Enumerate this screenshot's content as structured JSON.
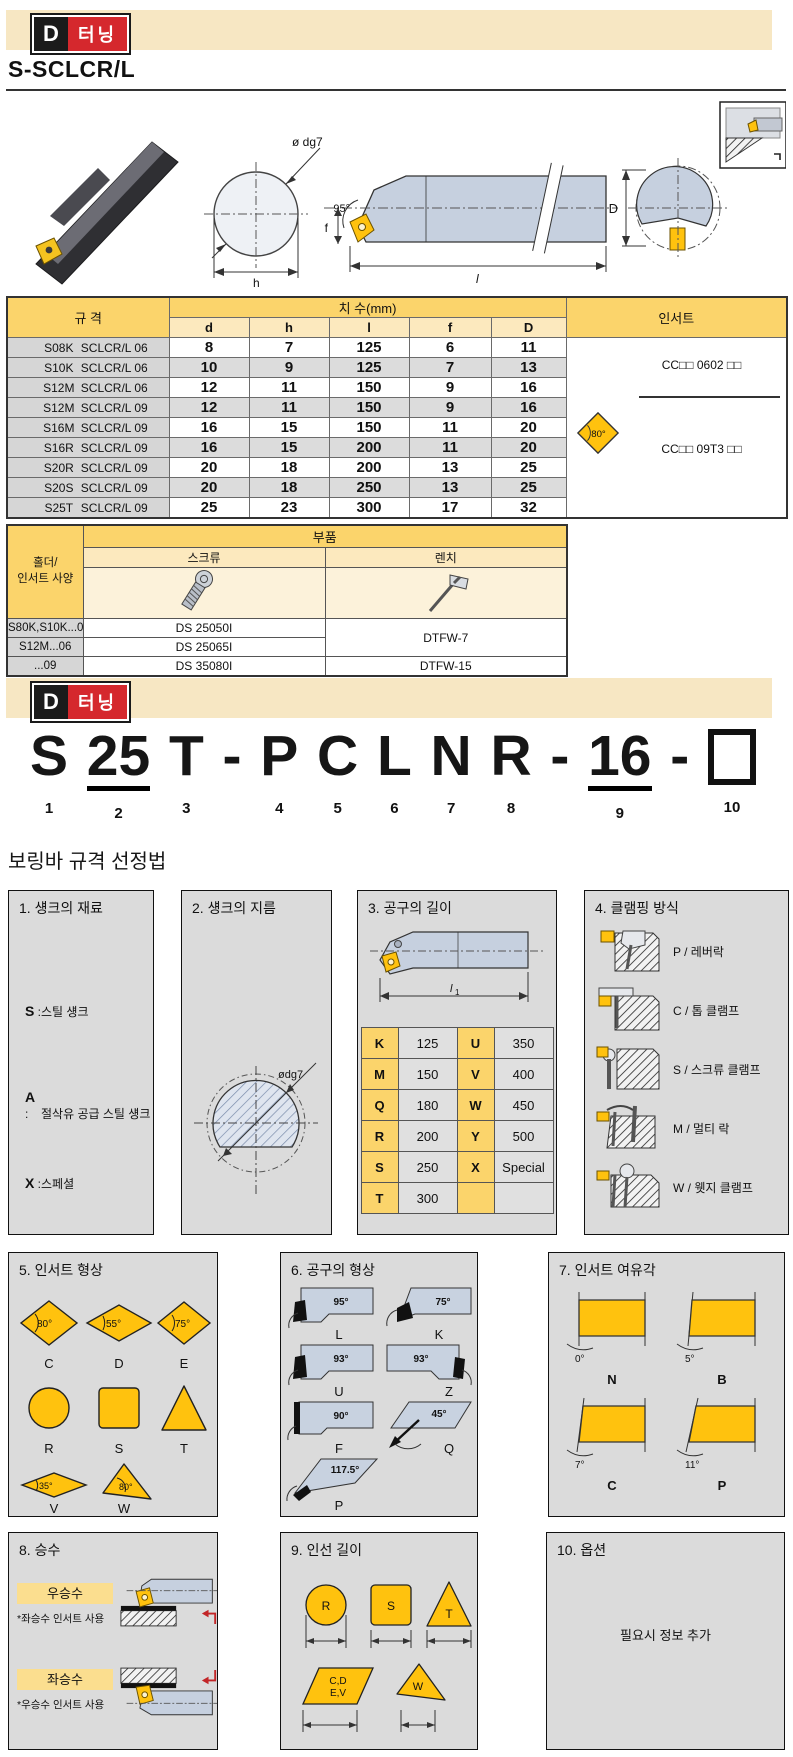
{
  "colors": {
    "bar_bg": "#F7E7C3",
    "logo_red": "#D5282D",
    "header_yellow": "#FBD46B",
    "subheader_yellow": "#FCE9BE",
    "image_row_cream": "#FCF2DA",
    "insert_yellow": "#FFC20E",
    "gray_cell": "#D6D6D6",
    "alt_row_gray": "#DCDCDC",
    "box_gray": "#DBDBDB",
    "steel_blue": "#C6D0DF"
  },
  "header": {
    "logo_d": "D",
    "logo_kr": "터닝",
    "title": "S-SCLCR/L"
  },
  "drawing": {
    "dg7": "ø dg7",
    "f_label": "f",
    "angle": "95°",
    "h_label": "h",
    "l_label": "l",
    "d_label": "D"
  },
  "spec_table": {
    "spec_header": "규 격",
    "dims_header": "치 수(mm)",
    "insert_header": "인서트",
    "sub_headers": [
      "d",
      "h",
      "l",
      "f",
      "D"
    ],
    "rows": [
      {
        "code": "S08K",
        "name": "SCLCR/L 06",
        "d": "8",
        "h": "7",
        "l": "125",
        "f": "6",
        "D": "11"
      },
      {
        "code": "S10K",
        "name": "SCLCR/L 06",
        "d": "10",
        "h": "9",
        "l": "125",
        "f": "7",
        "D": "13"
      },
      {
        "code": "S12M",
        "name": "SCLCR/L 06",
        "d": "12",
        "h": "11",
        "l": "150",
        "f": "9",
        "D": "16"
      },
      {
        "code": "S12M",
        "name": "SCLCR/L 09",
        "d": "12",
        "h": "11",
        "l": "150",
        "f": "9",
        "D": "16"
      },
      {
        "code": "S16M",
        "name": "SCLCR/L 09",
        "d": "16",
        "h": "15",
        "l": "150",
        "f": "11",
        "D": "20"
      },
      {
        "code": "S16R",
        "name": "SCLCR/L 09",
        "d": "16",
        "h": "15",
        "l": "200",
        "f": "11",
        "D": "20"
      },
      {
        "code": "S20R",
        "name": "SCLCR/L 09",
        "d": "20",
        "h": "18",
        "l": "200",
        "f": "13",
        "D": "25"
      },
      {
        "code": "S20S",
        "name": "SCLCR/L 09",
        "d": "20",
        "h": "18",
        "l": "250",
        "f": "13",
        "D": "25"
      },
      {
        "code": "S25T",
        "name": "SCLCR/L 09",
        "d": "25",
        "h": "23",
        "l": "300",
        "f": "17",
        "D": "32"
      }
    ],
    "insert_top": "CC□□ 0602 □□",
    "insert_bottom": "CC□□ 09T3 □□",
    "insert_angle": "80°"
  },
  "parts_table": {
    "holder_line1": "홀더/",
    "holder_line2": "인서트 사양",
    "parts_header": "부품",
    "screw_header": "스크류",
    "wrench_header": "렌치",
    "rows": [
      {
        "holder": "S80K,S10K...06",
        "screw": "DS 25050I",
        "wrench": "DTFW-7"
      },
      {
        "holder": "S12M...06",
        "screw": "DS 25065I"
      },
      {
        "holder": "...09",
        "screw": "DS 35080I",
        "wrench": "DTFW-15"
      }
    ]
  },
  "part_number": {
    "chars": [
      {
        "t": "S",
        "n": "1"
      },
      {
        "t": "25",
        "n": "2"
      },
      {
        "t": "T",
        "n": "3"
      },
      {
        "t": "-",
        "n": ""
      },
      {
        "t": "P",
        "n": "4"
      },
      {
        "t": "C",
        "n": "5"
      },
      {
        "t": "L",
        "n": "6"
      },
      {
        "t": "N",
        "n": "7"
      },
      {
        "t": "R",
        "n": "8"
      },
      {
        "t": "-",
        "n": ""
      },
      {
        "t": "16",
        "n": "9"
      },
      {
        "t": "-",
        "n": ""
      },
      {
        "t": "",
        "n": "10"
      }
    ]
  },
  "selection": {
    "title": "보링바 규격 선정법",
    "b1": {
      "title": "1. 섕크의 재료",
      "items": [
        {
          "k": "S",
          "v": "스틸 섕크"
        },
        {
          "k": "A",
          "v": "절삭유 공급 스틸 섕크"
        },
        {
          "k": "X",
          "v": "스페셜"
        }
      ]
    },
    "b2": {
      "title": "2. 섕크의 지름",
      "label": "ødg7"
    },
    "b3": {
      "title": "3. 공구의 길이",
      "dim": "l",
      "dimsub": "1",
      "rows": [
        [
          "K",
          "125",
          "U",
          "350"
        ],
        [
          "M",
          "150",
          "V",
          "400"
        ],
        [
          "Q",
          "180",
          "W",
          "450"
        ],
        [
          "R",
          "200",
          "Y",
          "500"
        ],
        [
          "S",
          "250",
          "X",
          "Special"
        ],
        [
          "T",
          "300",
          "",
          ""
        ]
      ]
    },
    "b4": {
      "title": "4. 클램핑 방식",
      "items": [
        "P / 레버락",
        "C / 톱 클램프",
        "S / 스크류 클램프",
        "M / 멀티 락",
        "W / 웻지 클램프"
      ]
    },
    "b5": {
      "title": "5. 인서트 형상",
      "shapes": [
        {
          "a": "80°",
          "l": "C"
        },
        {
          "a": "55°",
          "l": "D"
        },
        {
          "a": "75°",
          "l": "E"
        },
        {
          "a": "",
          "l": "R"
        },
        {
          "a": "",
          "l": "S"
        },
        {
          "a": "",
          "l": "T"
        },
        {
          "a": "35°",
          "l": "V"
        },
        {
          "a": "80°",
          "l": "W"
        }
      ]
    },
    "b6": {
      "title": "6. 공구의 형상",
      "shapes": [
        {
          "a": "95°",
          "l": "L"
        },
        {
          "a": "75°",
          "l": "K"
        },
        {
          "a": "93°",
          "l": "U"
        },
        {
          "a": "93°",
          "l": "Z"
        },
        {
          "a": "90°",
          "l": "F"
        },
        {
          "a": "45°",
          "l": "Q"
        },
        {
          "a": "117.5°",
          "l": "P"
        }
      ]
    },
    "b7": {
      "title": "7. 인서트 여유각",
      "shapes": [
        {
          "a": "0°",
          "l": "N"
        },
        {
          "a": "5°",
          "l": "B"
        },
        {
          "a": "7°",
          "l": "C"
        },
        {
          "a": "11°",
          "l": "P"
        }
      ]
    },
    "b8": {
      "title": "8. 승수",
      "items": [
        {
          "label": "우승수",
          "note": "*좌승수 인서트 사용"
        },
        {
          "label": "좌승수",
          "note": "*우승수 인서트 사용"
        }
      ]
    },
    "b9": {
      "title": "9. 인선 길이",
      "labels": {
        "r": "R",
        "s": "S",
        "t": "T",
        "cd": "C,D",
        "ev": "E,V",
        "w": "W"
      }
    },
    "b10": {
      "title": "10. 옵션",
      "note": "필요시 정보 추가"
    }
  }
}
